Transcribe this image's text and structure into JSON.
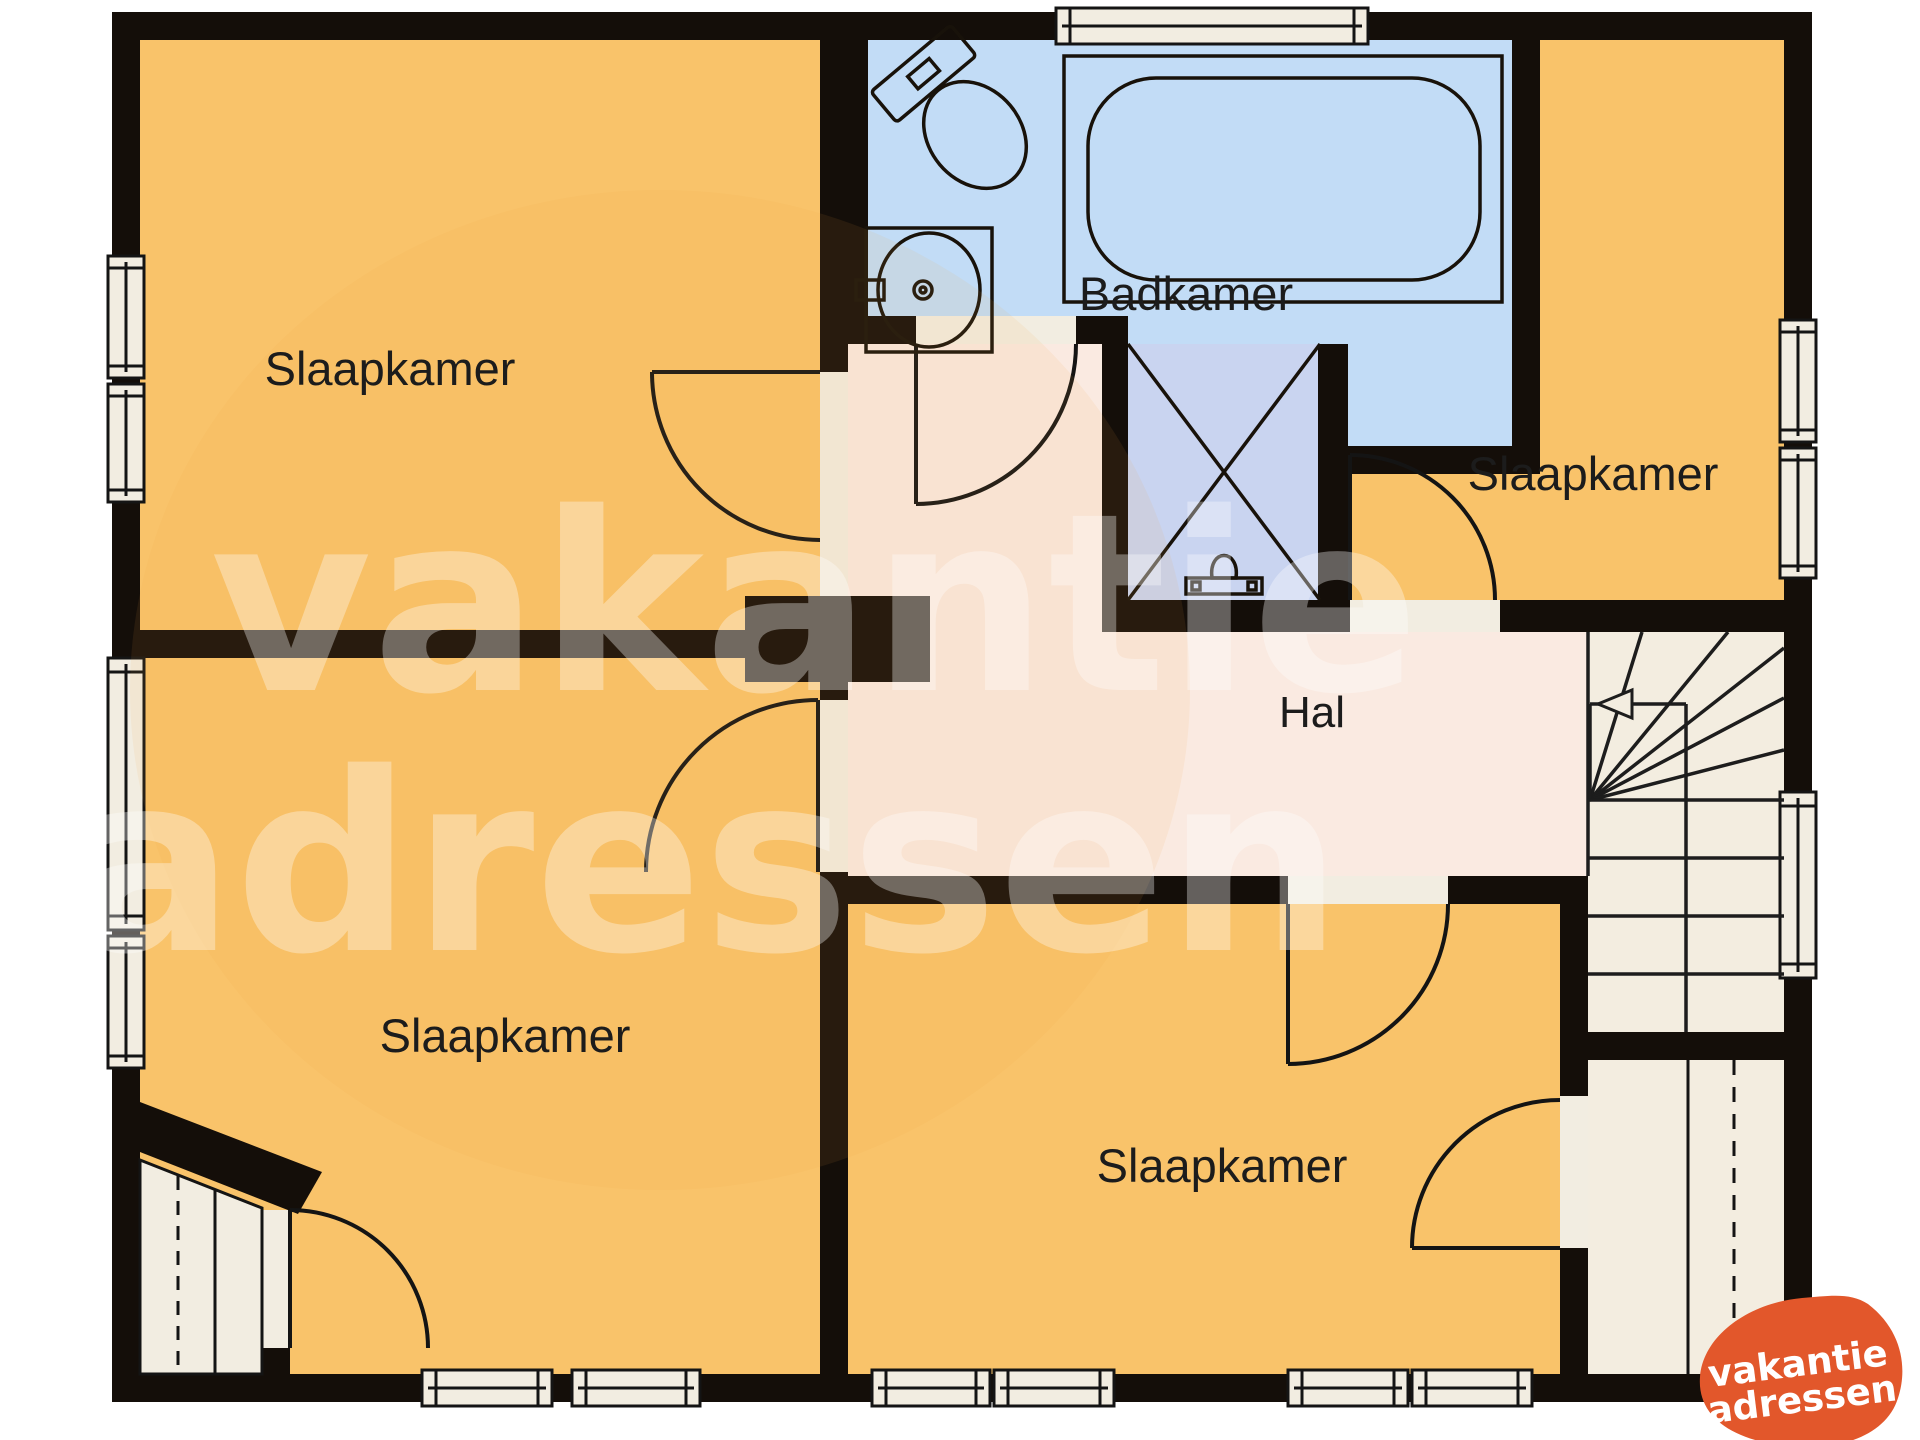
{
  "plan": {
    "type": "floorplan",
    "language": "Dutch",
    "rooms": {
      "bedroom_top_left": {
        "label": "Slaapkamer"
      },
      "bathroom": {
        "label": "Badkamer"
      },
      "bedroom_top_right": {
        "label": "Slaapkamer"
      },
      "hall": {
        "label": "Hal"
      },
      "bedroom_bottom_left": {
        "label": "Slaapkamer"
      },
      "bedroom_bottom_right": {
        "label": "Slaapkamer"
      }
    },
    "features": [
      "toilet",
      "sink",
      "bathtub",
      "shower",
      "winder-stairs",
      "dormer-closet",
      "13 windows",
      "7 doors"
    ]
  },
  "watermark": {
    "line1": "vakantie",
    "line2": "adressen"
  },
  "logo": {
    "line1": "vakantie",
    "line2": "adressen"
  },
  "colors": {
    "bedroom_fill": "#f9c36a",
    "bathroom_fill": "#c2dcf6",
    "shower_fill": "#c9d4f0",
    "hall_fill": "#faeae1",
    "stairs_fill": "#f3ede0",
    "window_fill": "#f2ede1",
    "wall": "#140e09",
    "logo_orange": "#e2572b",
    "label_text": "#1c1c1c"
  }
}
